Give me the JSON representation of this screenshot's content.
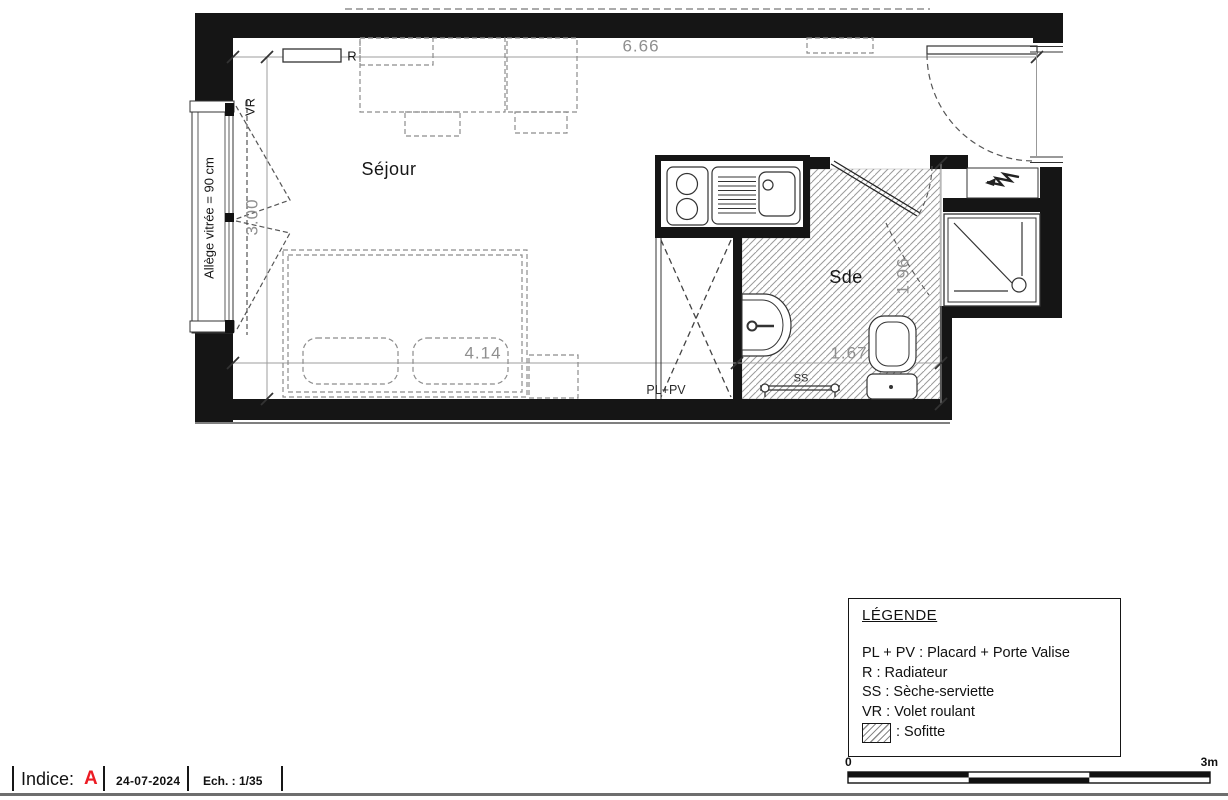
{
  "plan": {
    "rooms": {
      "sejour": "Séjour",
      "sde": "Sde"
    },
    "labels": {
      "radiator": "R",
      "roller_shutter": "VR",
      "towel_dryer": "SS",
      "closet": "PL+PV",
      "window_sill": "Allège vitrée = 90 cm"
    },
    "dimensions": {
      "top_width": "6.66",
      "left_height": "3.00",
      "sejour_width": "4.14",
      "sde_width": "1.67",
      "sde_height": "1.96"
    },
    "icons": {
      "electrical_panel": "lightning-bolt",
      "soffit_fill": "diagonal-hatch"
    }
  },
  "legend": {
    "title": "LÉGENDE",
    "items": [
      {
        "label": "PL + PV : Placard + Porte Valise"
      },
      {
        "label": "R : Radiateur"
      },
      {
        "label": "SS : Sèche-serviette"
      },
      {
        "label": "VR : Volet roulant"
      }
    ],
    "hatch_label": ": Sofitte"
  },
  "title_block": {
    "indice_label": "Indice:",
    "indice_value": "A",
    "indice_color": "#ec1c24",
    "date": "24-07-2024",
    "scale": "Ech. : 1/35"
  },
  "scale_bar": {
    "min_label": "0",
    "max_label": "3m"
  }
}
